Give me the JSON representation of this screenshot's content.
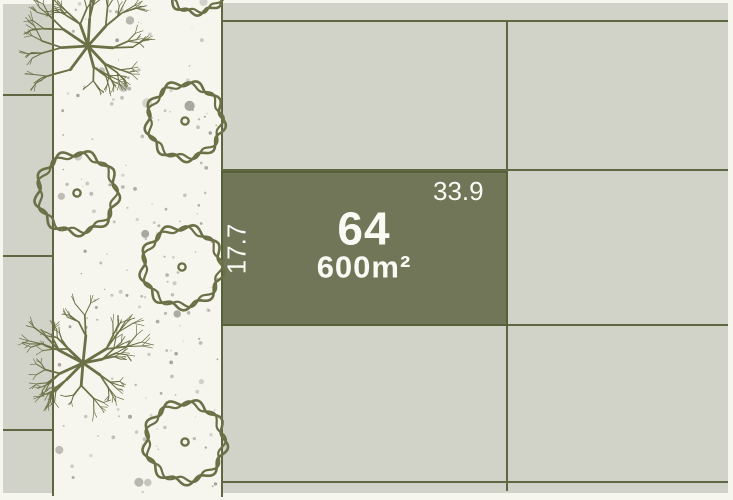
{
  "plan": {
    "colors": {
      "background": "#f7f6ee",
      "parcel_fill": "#d1d2c8",
      "boundary": "#5f6642",
      "highlight_fill": "#727659",
      "highlight_border": "#566039",
      "tree": "#6b7046",
      "speckle": "#8d8d85",
      "label_text": "#fafaf4"
    },
    "highlight": {
      "number": "64",
      "area": "600m²",
      "width_label": "33.9",
      "depth_label": "17.7",
      "x": 222,
      "y": 172,
      "w": 285,
      "h": 153
    },
    "parcels": [
      {
        "x": 3,
        "y": 4,
        "w": 50,
        "h": 91
      },
      {
        "x": 3,
        "y": 95,
        "w": 50,
        "h": 161
      },
      {
        "x": 3,
        "y": 256,
        "w": 50,
        "h": 174
      },
      {
        "x": 3,
        "y": 430,
        "w": 50,
        "h": 63
      },
      {
        "x": 222,
        "y": 3,
        "w": 285,
        "h": 18
      },
      {
        "x": 222,
        "y": 21,
        "w": 285,
        "h": 149
      },
      {
        "x": 222,
        "y": 325,
        "w": 285,
        "h": 157
      },
      {
        "x": 222,
        "y": 482,
        "w": 285,
        "h": 11
      },
      {
        "x": 507,
        "y": 3,
        "w": 221,
        "h": 18
      },
      {
        "x": 507,
        "y": 21,
        "w": 221,
        "h": 149
      },
      {
        "x": 507,
        "y": 170,
        "w": 221,
        "h": 155
      },
      {
        "x": 507,
        "y": 325,
        "w": 221,
        "h": 157
      },
      {
        "x": 507,
        "y": 482,
        "w": 221,
        "h": 11
      }
    ],
    "landscape_strip": {
      "x": 53,
      "y": 0,
      "w": 169,
      "h": 500
    },
    "boundaries": [
      {
        "x1": 53,
        "y1": 0,
        "x2": 53,
        "y2": 496
      },
      {
        "x1": 222,
        "y1": 2,
        "x2": 222,
        "y2": 497
      },
      {
        "x1": 507,
        "y1": 21,
        "x2": 507,
        "y2": 491
      },
      {
        "x1": 3,
        "y1": 95,
        "x2": 53,
        "y2": 95
      },
      {
        "x1": 3,
        "y1": 256,
        "x2": 53,
        "y2": 256
      },
      {
        "x1": 3,
        "y1": 430,
        "x2": 53,
        "y2": 430
      },
      {
        "x1": 222,
        "y1": 21,
        "x2": 728,
        "y2": 21
      },
      {
        "x1": 222,
        "y1": 170,
        "x2": 728,
        "y2": 170
      },
      {
        "x1": 222,
        "y1": 325,
        "x2": 728,
        "y2": 325
      },
      {
        "x1": 222,
        "y1": 482,
        "x2": 728,
        "y2": 482
      }
    ],
    "trees": [
      {
        "type": "branchy",
        "cx": 88,
        "cy": 46,
        "r": 52
      },
      {
        "type": "canopy",
        "cx": 185,
        "cy": 121,
        "r": 38
      },
      {
        "type": "canopy",
        "cx": 77,
        "cy": 193,
        "r": 40
      },
      {
        "type": "canopy",
        "cx": 182,
        "cy": 267,
        "r": 40
      },
      {
        "type": "branchy",
        "cx": 83,
        "cy": 363,
        "r": 48
      },
      {
        "type": "canopy",
        "cx": 185,
        "cy": 442,
        "r": 40
      },
      {
        "type": "canopy",
        "cx": 196,
        "cy": -19,
        "r": 32
      }
    ],
    "speckles": {
      "seed": 42,
      "count": 175,
      "x0": 58,
      "y0": 2,
      "x1": 218,
      "y1": 494
    }
  }
}
